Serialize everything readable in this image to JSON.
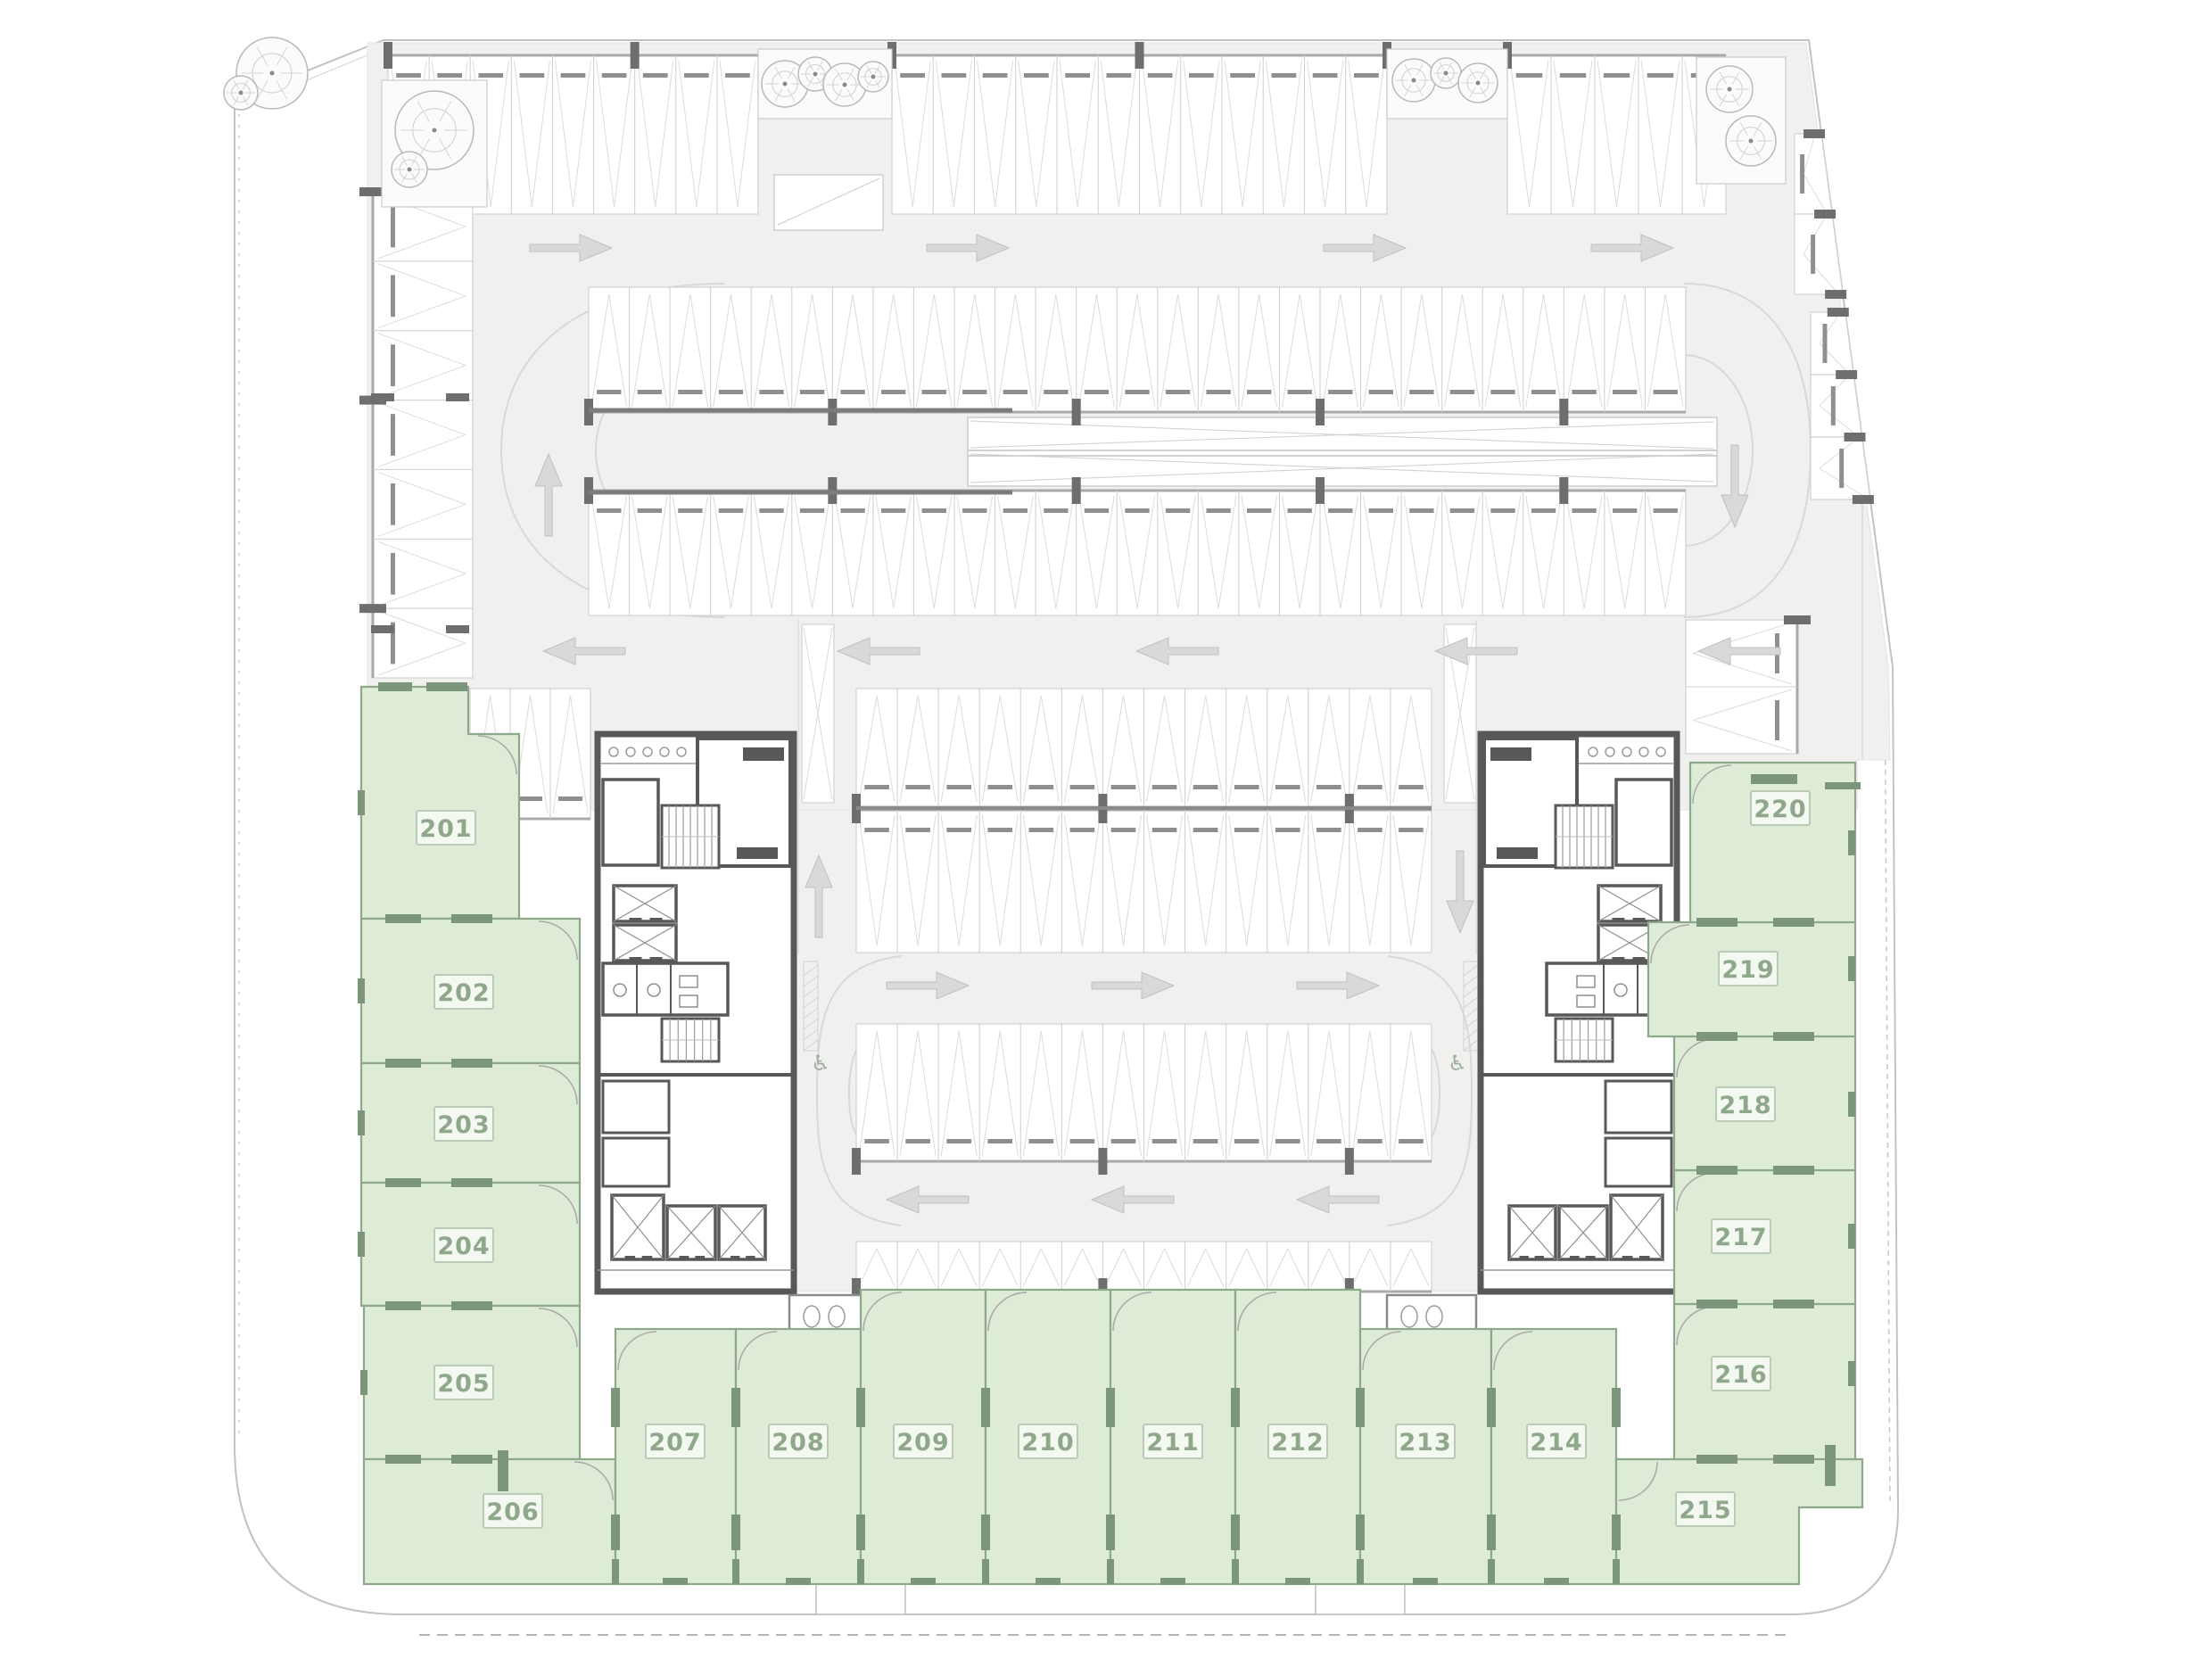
{
  "plan": {
    "type": "architectural-floor-plan",
    "floor_description": "Parking level with perimeter commercial units",
    "units": [
      {
        "id": "201",
        "label": "201"
      },
      {
        "id": "202",
        "label": "202"
      },
      {
        "id": "203",
        "label": "203"
      },
      {
        "id": "204",
        "label": "204"
      },
      {
        "id": "205",
        "label": "205"
      },
      {
        "id": "206",
        "label": "206"
      },
      {
        "id": "207",
        "label": "207"
      },
      {
        "id": "208",
        "label": "208"
      },
      {
        "id": "209",
        "label": "209"
      },
      {
        "id": "210",
        "label": "210"
      },
      {
        "id": "211",
        "label": "211"
      },
      {
        "id": "212",
        "label": "212"
      },
      {
        "id": "213",
        "label": "213"
      },
      {
        "id": "214",
        "label": "214"
      },
      {
        "id": "215",
        "label": "215"
      },
      {
        "id": "216",
        "label": "216"
      },
      {
        "id": "217",
        "label": "217"
      },
      {
        "id": "218",
        "label": "218"
      },
      {
        "id": "219",
        "label": "219"
      },
      {
        "id": "220",
        "label": "220"
      }
    ],
    "colors": {
      "unit_fill": "#deebd7",
      "unit_stroke": "#8ea88b",
      "unit_door_accent": "#7b967a",
      "badge_fill": "#f3f8f0",
      "badge_border": "#b9cbb4",
      "badge_text": "#8fa88b",
      "floor": "#f0f0ee",
      "stall_line": "#d2d2d2",
      "chevron": "#dcdcdc",
      "wall": "#585858",
      "column": "#6e6e6e",
      "lane_line": "#d8d8d8",
      "arrow": "#d9d9d9",
      "arrow_edge": "#c0c0c0",
      "tree_line": "#b9b9b9",
      "boundary": "#c2c2c2",
      "wheel_stop": "#8f8f8f",
      "fixture": "#9b9b9b"
    },
    "icons": {
      "wheelchair": "♿"
    }
  }
}
